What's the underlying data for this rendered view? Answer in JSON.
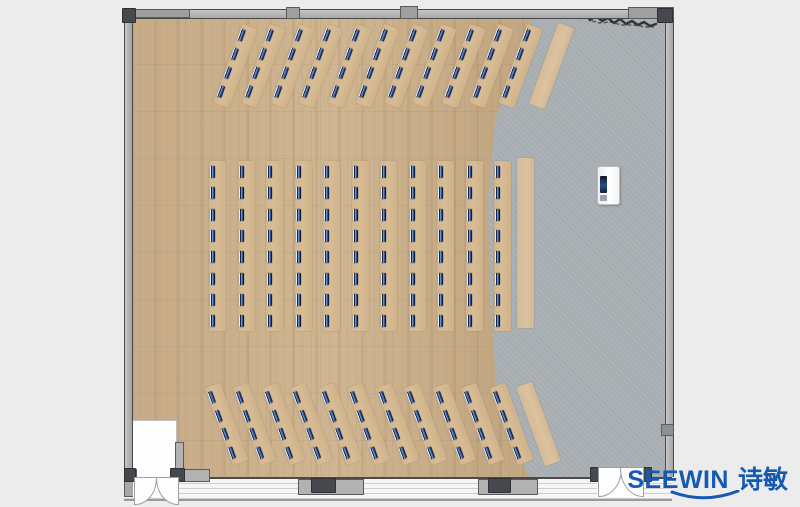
{
  "logo": {
    "latin": "SEEWIN",
    "cjk": "诗敏"
  },
  "colors": {
    "background": "#ececec",
    "wood_floor": "#c9ae8b",
    "gray_floor": "#a9afb3",
    "wall_fill": "#b3b3b3",
    "wall_edge": "#4a4a4a",
    "post": "#45494d",
    "desk": "#d7bc95",
    "desk_blank": "#dcc3a0",
    "monitor_navy": "#13254a",
    "monitor_highlight": "#6d8fc9",
    "door_white": "#fdfdfd",
    "logo_blue": "#1659b2"
  },
  "plan": {
    "bands": [
      {
        "name": "north-rows",
        "rotate": 20,
        "cy": 66,
        "strip_w": 17,
        "strip_h": 84,
        "cx0": 235,
        "dx": 28.5,
        "strips": 11,
        "monitors": 4,
        "mon_y0": 5,
        "mon_dy": 20,
        "blanks": [
          {
            "cx": 551,
            "h": 86
          }
        ]
      },
      {
        "name": "center-rows",
        "rotate": 0,
        "cy": 246,
        "strip_w": 17,
        "strip_h": 170,
        "cx0": 217.5,
        "dx": 28.5,
        "strips": 11,
        "monitors": 8,
        "mon_y0": 5,
        "mon_dy": 21.3,
        "blanks": [
          {
            "cx": 525,
            "h": 170,
            "cy": 243
          }
        ]
      },
      {
        "name": "south-rows",
        "rotate": -20,
        "cy": 424,
        "strip_w": 17,
        "strip_h": 82,
        "cx0": 226,
        "dx": 28.5,
        "strips": 11,
        "monitors": 4,
        "mon_y0": 5,
        "mon_dy": 19.5,
        "blanks": [
          {
            "cx": 538,
            "h": 84
          }
        ]
      }
    ]
  }
}
